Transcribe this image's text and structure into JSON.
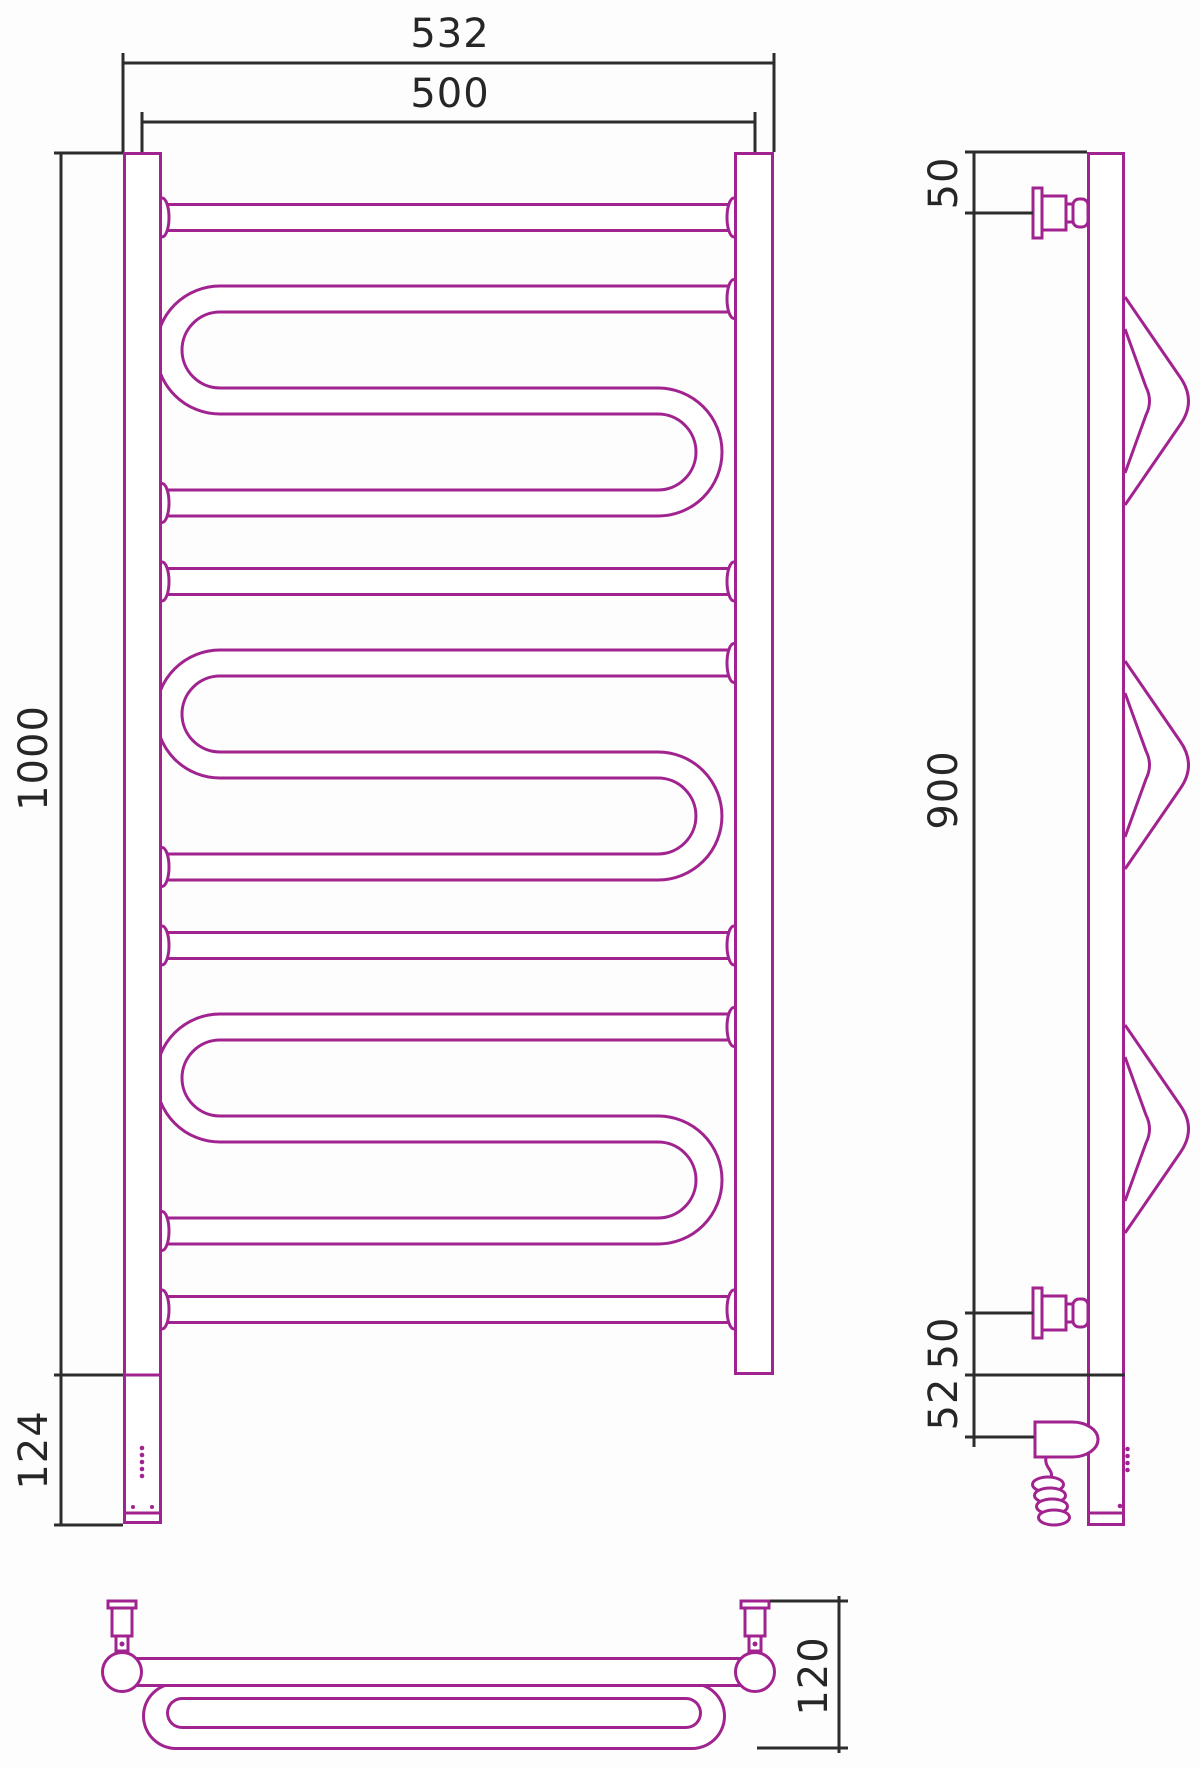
{
  "colors": {
    "outline": "#A1238F",
    "dimension_lines": "#2D2D2D",
    "label_text": "#262626",
    "background": "#FDFDFD"
  },
  "dimensions": {
    "front": {
      "overall_width": "532",
      "center_width": "500",
      "height": "1000",
      "heater_extension": "124"
    },
    "side": {
      "top_bracket_offset": "50",
      "bracket_span": "900",
      "bottom_bracket_offset": "50",
      "heater_offset": "52"
    },
    "bottom": {
      "depth": "120"
    }
  }
}
